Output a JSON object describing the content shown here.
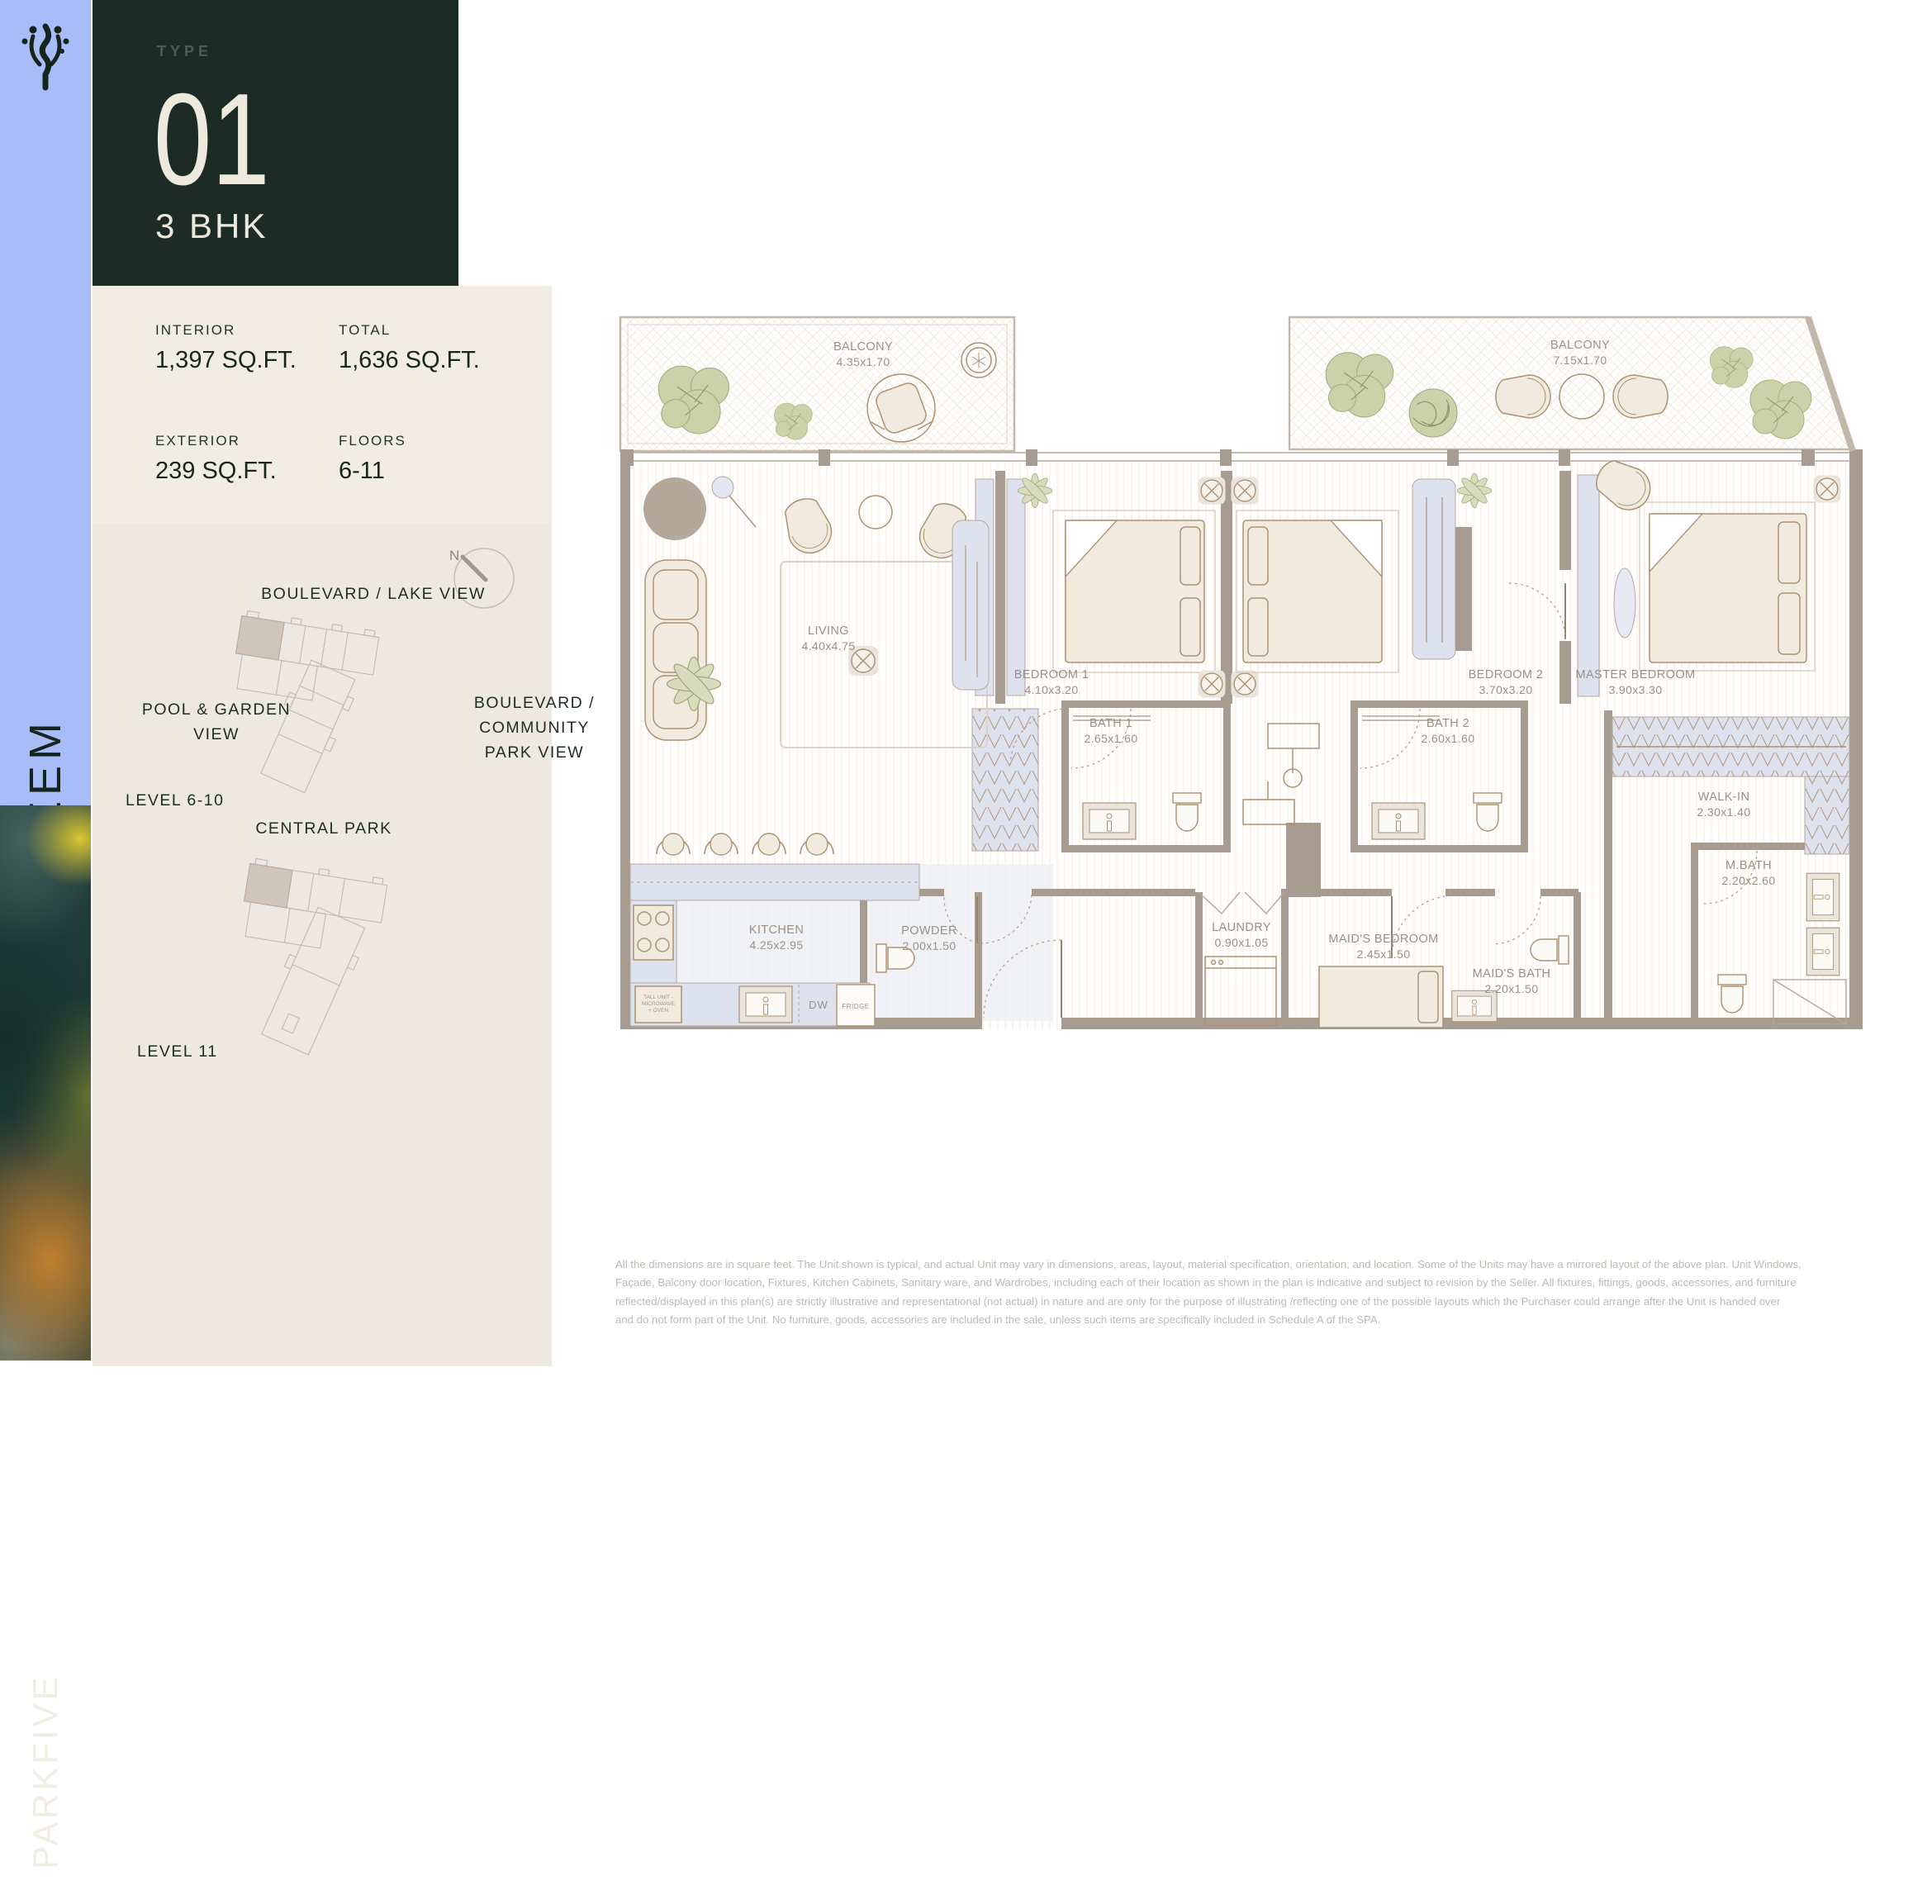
{
  "brand": {
    "logo": "plant-logo",
    "building_name": "NEEM",
    "project_name": "PARKFIVE"
  },
  "unit": {
    "type_label": "TYPE",
    "type_number": "01",
    "configuration": "3 BHK"
  },
  "stats": {
    "interior": {
      "label": "INTERIOR",
      "value": "1,397 SQ.FT."
    },
    "total": {
      "label": "TOTAL",
      "value": "1,636 SQ.FT."
    },
    "exterior": {
      "label": "EXTERIOR",
      "value": "239 SQ.FT."
    },
    "floors": {
      "label": "FLOORS",
      "value": "6-11"
    }
  },
  "location": {
    "compass": "N",
    "view_top": "BOULEVARD / LAKE VIEW",
    "view_left_line1": "POOL & GARDEN",
    "view_left_line2": "VIEW",
    "view_right_line1": "BOULEVARD /",
    "view_right_line2": "COMMUNITY",
    "view_right_line3": "PARK VIEW",
    "park": "CENTRAL PARK",
    "level_a": "LEVEL 6-10",
    "level_b": "LEVEL 11"
  },
  "floorplan": {
    "rooms": {
      "balcony_left": {
        "name": "BALCONY",
        "dims": "4.35x1.70"
      },
      "balcony_right": {
        "name": "BALCONY",
        "dims": "7.15x1.70"
      },
      "living": {
        "name": "LIVING",
        "dims": "4.40x4.75"
      },
      "bedroom1": {
        "name": "BEDROOM 1",
        "dims": "4.10x3.20"
      },
      "bedroom2": {
        "name": "BEDROOM 2",
        "dims": "3.70x3.20"
      },
      "master": {
        "name": "MASTER BEDROOM",
        "dims": "3.90x3.30"
      },
      "bath1": {
        "name": "BATH 1",
        "dims": "2.65x1.60"
      },
      "bath2": {
        "name": "BATH 2",
        "dims": "2.60x1.60"
      },
      "walkin": {
        "name": "WALK-IN",
        "dims": "2.30x1.40"
      },
      "mbath": {
        "name": "M.BATH",
        "dims": "2.20x2.60"
      },
      "kitchen": {
        "name": "KITCHEN",
        "dims": "4.25x2.95"
      },
      "powder": {
        "name": "POWDER",
        "dims": "2.00x1.50"
      },
      "laundry": {
        "name": "LAUNDRY",
        "dims": "0.90x1.05"
      },
      "maid_bedroom": {
        "name": "MAID'S BEDROOM",
        "dims": "2.45x1.50"
      },
      "maid_bath": {
        "name": "MAID'S BATH",
        "dims": "2.20x1.50"
      }
    },
    "appliances": {
      "dw": "DW",
      "fridge": "FRIDGE",
      "tall_unit_line1": "TALL UNIT -",
      "tall_unit_line2": "MICROWAVE",
      "tall_unit_line3": "+ OVEN"
    }
  },
  "disclaimer": {
    "line1": "All the dimensions are in square feet. The Unit shown is typical, and actual Unit may vary in dimensions, areas, layout, material specification, orientation, and location. Some of the Units may have a mirrored layout of the above plan. Unit Windows,",
    "line2": "Façade, Balcony door location, Fixtures, Kitchen Cabinets, Sanitary ware, and Wardrobes, including each of their location as shown in the plan is indicative and subject to revision by the Seller. All fixtures, fittings, goods, accessories, and furniture",
    "line3": "reflected/displayed in this plan(s) are strictly illustrative and representational (not actual) in nature and are only for the purpose of illustrating /reflecting one of the possible layouts which the Purchaser could arrange after the Unit is handed over",
    "line4": "and do not form part of the Unit. No furniture, goods, accessories are included in the sale, unless such items are specifically included in Schedule A of the SPA."
  }
}
